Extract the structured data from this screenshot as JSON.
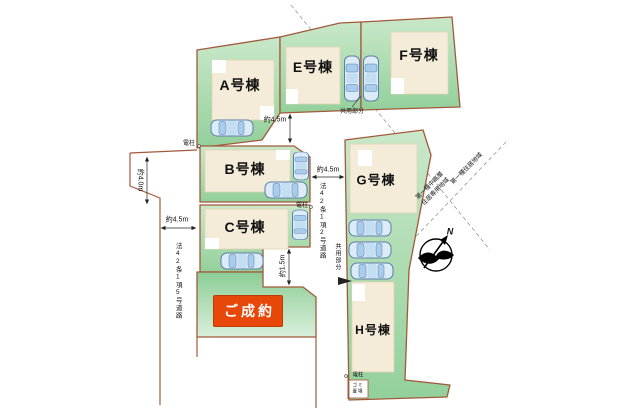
{
  "site_plan": {
    "lots": [
      {
        "label": "A号棟"
      },
      {
        "label": "E号棟"
      },
      {
        "label": "F号棟"
      },
      {
        "label": "B号棟"
      },
      {
        "label": "C号棟"
      },
      {
        "label": "G号棟"
      },
      {
        "label": "H号棟"
      }
    ],
    "sold_label": "ご成約",
    "road_left_label": "法42条1項5号道路",
    "road_center_label": "法42条1項2号道路",
    "dimensions": {
      "left_depth": "約4.0m",
      "left_width": "約4.5m",
      "top_width": "約4.5m",
      "center_width": "約4.5m",
      "path_width": "約1.5m"
    },
    "pole_label": "電柱",
    "shared_label": "共用部分",
    "garbage_label": "ゴミ置場",
    "zoning": {
      "left_line1": "第一種中高層",
      "left_line2": "住居専用地域",
      "right": "第一種住居地域"
    },
    "compass_north": "N",
    "colors": {
      "lot_green_light": "#c9e8c9",
      "lot_green_dark": "#93d09b",
      "lot_border": "#a2593b",
      "building_fill": "#f4ecd9",
      "sold_badge": "#e8470a",
      "car_body": "#dcebf8",
      "car_outline": "#5b7da8"
    }
  }
}
